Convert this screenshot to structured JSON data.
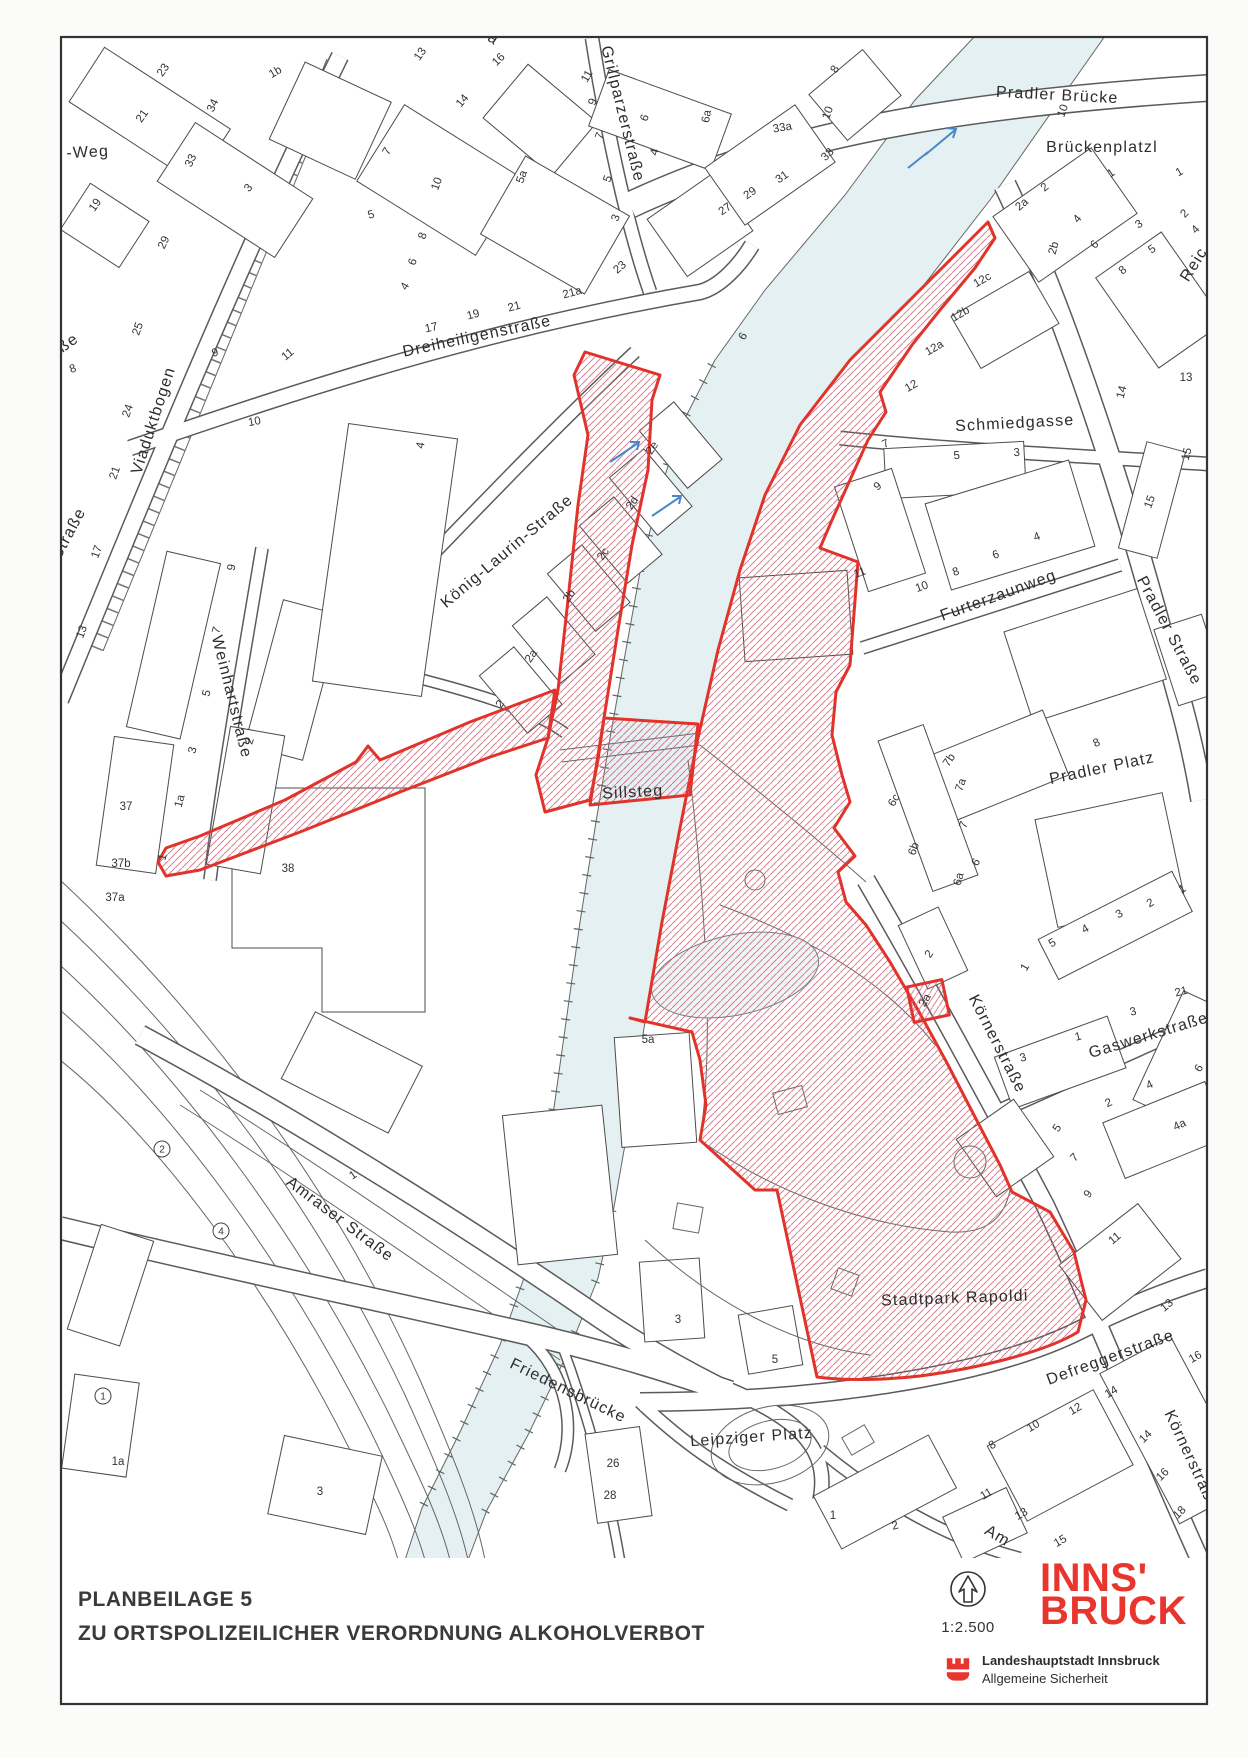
{
  "footer": {
    "title_line1": "PLANBEILAGE 5",
    "title_line2": "ZU ORTSPOLIZEILICHER VERORDNUNG ALKOHOLVERBOT",
    "scale_label": "1:2.500",
    "logo_line1": "INNS'",
    "logo_line2": "BRUCK",
    "org_line1": "Landeshauptstadt Innsbruck",
    "org_line2": "Allgemeine Sicherheit"
  },
  "colors": {
    "zone_red": "#e2332b",
    "hatch_pink": "#cf5f78",
    "river_fill": "#e4f0f1",
    "river_edge": "#6a8288",
    "logo_red": "#e8352e",
    "arrow_blue": "#4a86c8",
    "line_grey": "#4c4c4c"
  },
  "labels": {
    "streets": [
      {
        "t": "Pradler Brücke",
        "x": 1057,
        "y": 100,
        "r": 3
      },
      {
        "t": "Brückenplatzl",
        "x": 1102,
        "y": 152,
        "r": 0
      },
      {
        "t": "Schmiedgasse",
        "x": 1015,
        "y": 428,
        "r": -3
      },
      {
        "t": "Furterzaunweg",
        "x": 1000,
        "y": 600,
        "r": -20
      },
      {
        "t": "Pradler Straße",
        "x": 1165,
        "y": 633,
        "r": 62
      },
      {
        "t": "Pradler Platz",
        "x": 1103,
        "y": 773,
        "r": -12
      },
      {
        "t": "Körnerstraße",
        "x": 993,
        "y": 1046,
        "r": 63
      },
      {
        "t": "Gaswerkstraße",
        "x": 1150,
        "y": 1040,
        "r": -17
      },
      {
        "t": "Stadtpark Rapoldi",
        "x": 955,
        "y": 1303,
        "r": -2,
        "s": 19
      },
      {
        "t": "Defreggerstraße",
        "x": 1112,
        "y": 1362,
        "r": -20
      },
      {
        "t": "Körnerstraße",
        "x": 1187,
        "y": 1462,
        "r": 65
      },
      {
        "t": "Amraser Straße",
        "x": 337,
        "y": 1223,
        "r": 37
      },
      {
        "t": "Friedensbrücke",
        "x": 566,
        "y": 1395,
        "r": 26
      },
      {
        "t": "Leipziger Platz",
        "x": 752,
        "y": 1442,
        "r": -4
      },
      {
        "t": "Dreiheiligenstraße",
        "x": 478,
        "y": 341,
        "r": -12
      },
      {
        "t": "Grillparzerstraße",
        "x": 618,
        "y": 115,
        "r": 76
      },
      {
        "t": "König-Laurin-Straße",
        "x": 510,
        "y": 555,
        "r": -40
      },
      {
        "t": "Viaduktbogen",
        "x": 158,
        "y": 422,
        "r": -72
      },
      {
        "t": "Weinhartstraße",
        "x": 227,
        "y": 698,
        "r": 76
      },
      {
        "t": "Sillsteg",
        "x": 633,
        "y": 797,
        "r": -3,
        "s": 15
      },
      {
        "t": "-Weg",
        "x": 88,
        "y": 157,
        "r": -3,
        "s": 15
      },
      {
        "t": "ße",
        "x": 71,
        "y": 347,
        "r": -35,
        "s": 15
      },
      {
        "t": "el-Straße",
        "x": 68,
        "y": 545,
        "r": -62,
        "s": 14
      },
      {
        "t": "Reic",
        "x": 1198,
        "y": 267,
        "r": -58,
        "s": 15
      },
      {
        "t": "Ja",
        "x": 487,
        "y": 40,
        "r": 35,
        "s": 14
      },
      {
        "t": "Am",
        "x": 995,
        "y": 1540,
        "r": 30,
        "s": 15
      }
    ],
    "numbers": [
      {
        "t": "23",
        "x": 166,
        "y": 72,
        "r": -55
      },
      {
        "t": "21",
        "x": 145,
        "y": 118,
        "r": -55
      },
      {
        "t": "19",
        "x": 98,
        "y": 207,
        "r": -55
      },
      {
        "t": "1b",
        "x": 277,
        "y": 75,
        "r": -30
      },
      {
        "t": "34",
        "x": 216,
        "y": 107,
        "r": -65
      },
      {
        "t": "33",
        "x": 194,
        "y": 162,
        "r": -65
      },
      {
        "t": "3",
        "x": 251,
        "y": 190,
        "r": -50
      },
      {
        "t": "29",
        "x": 167,
        "y": 244,
        "r": -65
      },
      {
        "t": "25",
        "x": 141,
        "y": 330,
        "r": -70
      },
      {
        "t": "24",
        "x": 131,
        "y": 412,
        "r": -70
      },
      {
        "t": "21",
        "x": 118,
        "y": 474,
        "r": -70
      },
      {
        "t": "17",
        "x": 100,
        "y": 553,
        "r": -70
      },
      {
        "t": "13",
        "x": 85,
        "y": 633,
        "r": -70
      },
      {
        "t": "8",
        "x": 74,
        "y": 372,
        "r": -20
      },
      {
        "t": "9",
        "x": 216,
        "y": 356,
        "r": -15
      },
      {
        "t": "11",
        "x": 290,
        "y": 357,
        "r": -40
      },
      {
        "t": "10",
        "x": 255,
        "y": 425,
        "r": -10
      },
      {
        "t": "9",
        "x": 235,
        "y": 568,
        "r": -80
      },
      {
        "t": "9",
        "x": 43,
        "y": 716,
        "r": -75
      },
      {
        "t": "7",
        "x": 220,
        "y": 631,
        "r": -75
      },
      {
        "t": "5",
        "x": 210,
        "y": 694,
        "r": -75
      },
      {
        "t": "3",
        "x": 196,
        "y": 751,
        "r": -75
      },
      {
        "t": "1a",
        "x": 183,
        "y": 802,
        "r": -75
      },
      {
        "t": "1",
        "x": 166,
        "y": 858,
        "r": -75
      },
      {
        "t": "2",
        "x": 253,
        "y": 742,
        "r": -70
      },
      {
        "t": "37",
        "x": 126,
        "y": 810,
        "r": 0
      },
      {
        "t": "37b",
        "x": 121,
        "y": 867,
        "r": 0
      },
      {
        "t": "37a",
        "x": 115,
        "y": 901,
        "r": 0
      },
      {
        "t": "38",
        "x": 288,
        "y": 872,
        "r": 0
      },
      {
        "t": "13",
        "x": 423,
        "y": 56,
        "r": -55
      },
      {
        "t": "16",
        "x": 501,
        "y": 62,
        "r": -45
      },
      {
        "t": "14",
        "x": 465,
        "y": 103,
        "r": -50
      },
      {
        "t": "7",
        "x": 390,
        "y": 153,
        "r": -60
      },
      {
        "t": "5",
        "x": 372,
        "y": 218,
        "r": -15
      },
      {
        "t": "10",
        "x": 440,
        "y": 185,
        "r": -70
      },
      {
        "t": "8",
        "x": 426,
        "y": 237,
        "r": -70
      },
      {
        "t": "6",
        "x": 416,
        "y": 263,
        "r": -70
      },
      {
        "t": "4",
        "x": 408,
        "y": 288,
        "r": -60
      },
      {
        "t": "5a",
        "x": 525,
        "y": 178,
        "r": -70
      },
      {
        "t": "11",
        "x": 590,
        "y": 78,
        "r": -60
      },
      {
        "t": "9",
        "x": 596,
        "y": 103,
        "r": -70
      },
      {
        "t": "7",
        "x": 603,
        "y": 137,
        "r": -70
      },
      {
        "t": "5",
        "x": 611,
        "y": 180,
        "r": -70
      },
      {
        "t": "3",
        "x": 619,
        "y": 219,
        "r": -70
      },
      {
        "t": "6",
        "x": 648,
        "y": 119,
        "r": -70
      },
      {
        "t": "4",
        "x": 658,
        "y": 153,
        "r": -75
      },
      {
        "t": "6a",
        "x": 710,
        "y": 117,
        "r": -80
      },
      {
        "t": "23",
        "x": 622,
        "y": 270,
        "r": -40
      },
      {
        "t": "21a",
        "x": 573,
        "y": 296,
        "r": -15
      },
      {
        "t": "21",
        "x": 515,
        "y": 310,
        "r": -15
      },
      {
        "t": "19",
        "x": 474,
        "y": 318,
        "r": -15
      },
      {
        "t": "17",
        "x": 432,
        "y": 331,
        "r": -12
      },
      {
        "t": "27",
        "x": 727,
        "y": 212,
        "r": -35
      },
      {
        "t": "29",
        "x": 752,
        "y": 196,
        "r": -35
      },
      {
        "t": "31",
        "x": 784,
        "y": 180,
        "r": -35
      },
      {
        "t": "33",
        "x": 830,
        "y": 157,
        "r": -45
      },
      {
        "t": "33a",
        "x": 783,
        "y": 131,
        "r": -10
      },
      {
        "t": "10",
        "x": 831,
        "y": 114,
        "r": -70
      },
      {
        "t": "8",
        "x": 838,
        "y": 71,
        "r": -60
      },
      {
        "t": "10",
        "x": 1066,
        "y": 112,
        "r": -70
      },
      {
        "t": "2",
        "x": 503,
        "y": 706,
        "r": -55
      },
      {
        "t": "2a",
        "x": 534,
        "y": 658,
        "r": -55
      },
      {
        "t": "2b",
        "x": 572,
        "y": 598,
        "r": -55
      },
      {
        "t": "2c",
        "x": 606,
        "y": 556,
        "r": -55
      },
      {
        "t": "2d",
        "x": 635,
        "y": 505,
        "r": -55
      },
      {
        "t": "2e",
        "x": 655,
        "y": 450,
        "r": -55
      },
      {
        "t": "4",
        "x": 424,
        "y": 446,
        "r": -80
      },
      {
        "t": "6",
        "x": 746,
        "y": 338,
        "r": -60
      },
      {
        "t": "2",
        "x": 1047,
        "y": 190,
        "r": -40
      },
      {
        "t": "2a",
        "x": 1024,
        "y": 207,
        "r": -40
      },
      {
        "t": "2b",
        "x": 1057,
        "y": 249,
        "r": -75
      },
      {
        "t": "4",
        "x": 1080,
        "y": 221,
        "r": -50
      },
      {
        "t": "6",
        "x": 1097,
        "y": 247,
        "r": -45
      },
      {
        "t": "8",
        "x": 1125,
        "y": 273,
        "r": -40
      },
      {
        "t": "1",
        "x": 1113,
        "y": 176,
        "r": -35
      },
      {
        "t": "1",
        "x": 1181,
        "y": 175,
        "r": -30
      },
      {
        "t": "3",
        "x": 1141,
        "y": 227,
        "r": -35
      },
      {
        "t": "5",
        "x": 1154,
        "y": 252,
        "r": -35
      },
      {
        "t": "2",
        "x": 1187,
        "y": 216,
        "r": -45
      },
      {
        "t": "4",
        "x": 1198,
        "y": 232,
        "r": -45
      },
      {
        "t": "12c",
        "x": 984,
        "y": 283,
        "r": -30
      },
      {
        "t": "12b",
        "x": 962,
        "y": 317,
        "r": -30
      },
      {
        "t": "12a",
        "x": 936,
        "y": 351,
        "r": -30
      },
      {
        "t": "12",
        "x": 913,
        "y": 389,
        "r": -30
      },
      {
        "t": "7",
        "x": 887,
        "y": 447,
        "r": -25
      },
      {
        "t": "5",
        "x": 957,
        "y": 459,
        "r": -4
      },
      {
        "t": "3",
        "x": 1017,
        "y": 456,
        "r": -4
      },
      {
        "t": "9",
        "x": 880,
        "y": 489,
        "r": -40
      },
      {
        "t": "11",
        "x": 861,
        "y": 576,
        "r": -20
      },
      {
        "t": "10",
        "x": 923,
        "y": 590,
        "r": -20
      },
      {
        "t": "8",
        "x": 957,
        "y": 575,
        "r": -20
      },
      {
        "t": "6",
        "x": 997,
        "y": 558,
        "r": -20
      },
      {
        "t": "4",
        "x": 1038,
        "y": 540,
        "r": -20
      },
      {
        "t": "15",
        "x": 1153,
        "y": 503,
        "r": -70
      },
      {
        "t": "14",
        "x": 1125,
        "y": 393,
        "r": -75
      },
      {
        "t": "13",
        "x": 1186,
        "y": 381,
        "r": 0
      },
      {
        "t": "15",
        "x": 1190,
        "y": 455,
        "r": -75
      },
      {
        "t": "8",
        "x": 1098,
        "y": 746,
        "r": -25
      },
      {
        "t": "7b",
        "x": 952,
        "y": 762,
        "r": -55
      },
      {
        "t": "7a",
        "x": 964,
        "y": 786,
        "r": -70
      },
      {
        "t": "7",
        "x": 967,
        "y": 826,
        "r": -70
      },
      {
        "t": "6",
        "x": 979,
        "y": 864,
        "r": -60
      },
      {
        "t": "6a",
        "x": 962,
        "y": 880,
        "r": -75
      },
      {
        "t": "6b",
        "x": 917,
        "y": 850,
        "r": -70
      },
      {
        "t": "6c",
        "x": 897,
        "y": 802,
        "r": -60
      },
      {
        "t": "2",
        "x": 932,
        "y": 956,
        "r": -55
      },
      {
        "t": "1",
        "x": 1184,
        "y": 892,
        "r": -30
      },
      {
        "t": "2",
        "x": 1152,
        "y": 906,
        "r": -30
      },
      {
        "t": "3",
        "x": 1121,
        "y": 917,
        "r": -30
      },
      {
        "t": "4",
        "x": 1087,
        "y": 932,
        "r": -30
      },
      {
        "t": "5",
        "x": 1054,
        "y": 946,
        "r": -30
      },
      {
        "t": "2a",
        "x": 928,
        "y": 1002,
        "r": -60
      },
      {
        "t": "1",
        "x": 1028,
        "y": 969,
        "r": -60
      },
      {
        "t": "3",
        "x": 1024,
        "y": 1061,
        "r": -15
      },
      {
        "t": "1",
        "x": 1079,
        "y": 1040,
        "r": -15
      },
      {
        "t": "3",
        "x": 1134,
        "y": 1015,
        "r": -15
      },
      {
        "t": "21",
        "x": 1182,
        "y": 995,
        "r": -15
      },
      {
        "t": "2",
        "x": 1110,
        "y": 1106,
        "r": -25
      },
      {
        "t": "4",
        "x": 1151,
        "y": 1088,
        "r": -25
      },
      {
        "t": "4a",
        "x": 1181,
        "y": 1128,
        "r": -25
      },
      {
        "t": "6",
        "x": 1202,
        "y": 1070,
        "r": -60
      },
      {
        "t": "5",
        "x": 1060,
        "y": 1130,
        "r": -55
      },
      {
        "t": "7",
        "x": 1077,
        "y": 1160,
        "r": -45
      },
      {
        "t": "9",
        "x": 1091,
        "y": 1196,
        "r": -55
      },
      {
        "t": "11",
        "x": 1117,
        "y": 1241,
        "r": -40
      },
      {
        "t": "13",
        "x": 1169,
        "y": 1308,
        "r": -40
      },
      {
        "t": "16",
        "x": 1197,
        "y": 1360,
        "r": -30
      },
      {
        "t": "14",
        "x": 1113,
        "y": 1395,
        "r": -30
      },
      {
        "t": "12",
        "x": 1077,
        "y": 1412,
        "r": -30
      },
      {
        "t": "10",
        "x": 1035,
        "y": 1429,
        "r": -30
      },
      {
        "t": "8",
        "x": 994,
        "y": 1448,
        "r": -30
      },
      {
        "t": "14",
        "x": 1148,
        "y": 1439,
        "r": -45
      },
      {
        "t": "16",
        "x": 1165,
        "y": 1477,
        "r": -45
      },
      {
        "t": "18",
        "x": 1182,
        "y": 1515,
        "r": -45
      },
      {
        "t": "11",
        "x": 988,
        "y": 1497,
        "r": -30
      },
      {
        "t": "13",
        "x": 1023,
        "y": 1517,
        "r": -30
      },
      {
        "t": "15",
        "x": 1062,
        "y": 1544,
        "r": -30
      },
      {
        "t": "1",
        "x": 833,
        "y": 1519,
        "r": 0
      },
      {
        "t": "2",
        "x": 896,
        "y": 1529,
        "r": -15
      },
      {
        "t": "3",
        "x": 678,
        "y": 1323,
        "r": 0
      },
      {
        "t": "5",
        "x": 775,
        "y": 1363,
        "r": 0
      },
      {
        "t": "5a",
        "x": 648,
        "y": 1043,
        "r": 0
      },
      {
        "t": "26",
        "x": 613,
        "y": 1467,
        "r": 0
      },
      {
        "t": "28",
        "x": 610,
        "y": 1499,
        "r": 0
      },
      {
        "t": "3",
        "x": 320,
        "y": 1495,
        "r": 0
      },
      {
        "t": "1a",
        "x": 118,
        "y": 1465,
        "r": 0
      },
      {
        "t": "1",
        "x": 355,
        "y": 1178,
        "r": -35
      }
    ],
    "circled": [
      {
        "t": "2",
        "x": 162,
        "y": 1149
      },
      {
        "t": "4",
        "x": 221,
        "y": 1231
      },
      {
        "t": "1",
        "x": 103,
        "y": 1396
      }
    ]
  }
}
